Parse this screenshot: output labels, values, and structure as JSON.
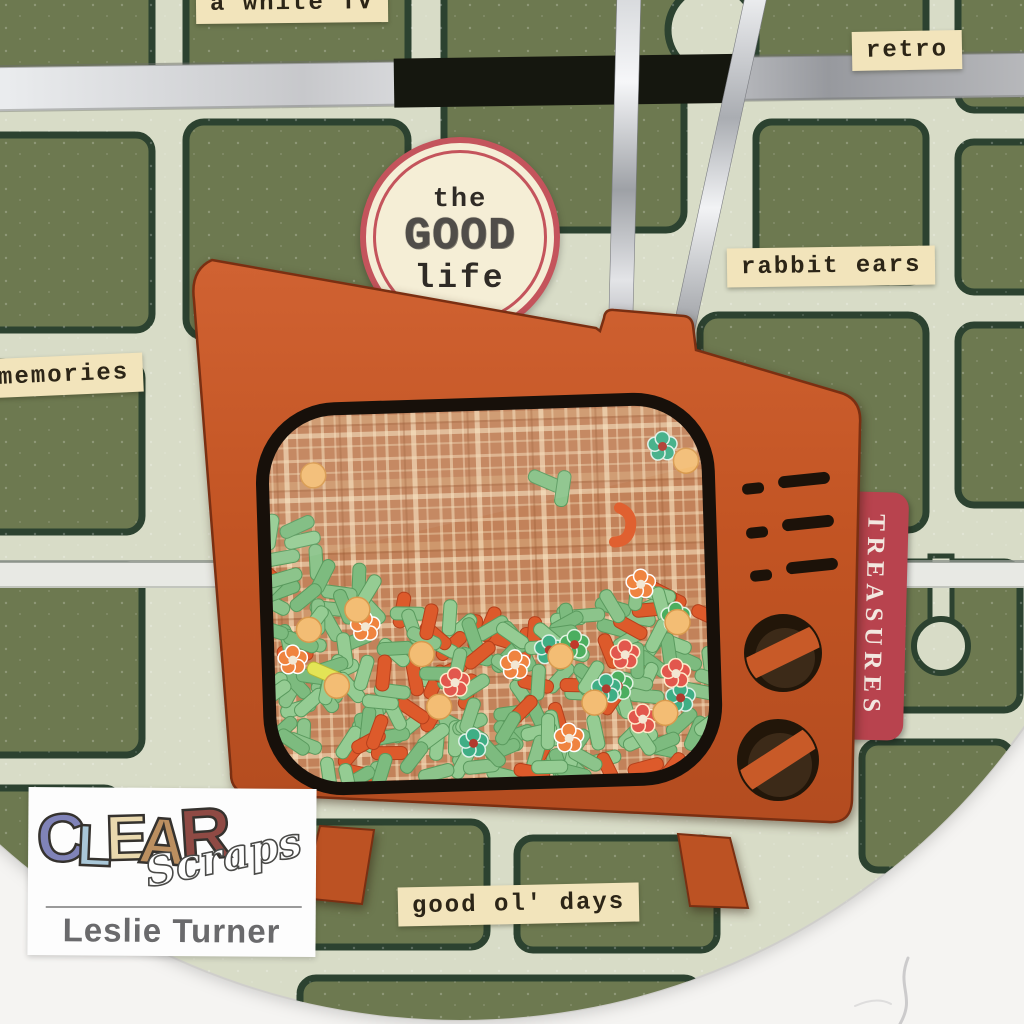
{
  "stickers": {
    "top_partial": "a white TV",
    "retro": "retro",
    "rabbit_ears": "rabbit ears",
    "memories": "memories",
    "good_ol_days": "good ol' days"
  },
  "badge": {
    "line1": "the",
    "line2": "GOOD",
    "line3": "life"
  },
  "tab": {
    "label": "TREASURES"
  },
  "logo": {
    "letters": [
      {
        "ch": "C",
        "color": "#8083b8",
        "rot": -5,
        "dy": 6,
        "size": 68
      },
      {
        "ch": "L",
        "color": "#a9c7d8",
        "rot": 2,
        "dy": 10,
        "size": 58
      },
      {
        "ch": "E",
        "color": "#ead9ae",
        "rot": -2,
        "dy": 4,
        "size": 64
      },
      {
        "ch": "A",
        "color": "#bb8f60",
        "rot": 4,
        "dy": 8,
        "size": 66
      },
      {
        "ch": "R",
        "color": "#8f4a44",
        "rot": -4,
        "dy": 2,
        "size": 72
      }
    ],
    "script": "Scraps",
    "byline": "Leslie Turner"
  },
  "colors": {
    "page": "#f5f4f2",
    "plaque_green": "#6d7950",
    "road": "#d8dcc7",
    "outline": "#2c4230",
    "tv": "#c85a28",
    "screen_base": "#c2825a",
    "tab": "#b8434e",
    "sticker_bg": "#f2e4bb",
    "sticker_text": "#2c2517",
    "badge_bg": "#f5eed6",
    "badge_ring": "#c4545c",
    "antenna": "#c9cbcf",
    "sprinkle_green": "#84c083",
    "sprinkle_orange": "#dd5a2b",
    "flower_teal": "#3fae85",
    "flower_orange": "#ef8440",
    "dot_peach": "#f3bd74"
  },
  "shaker": {
    "seed": 11,
    "rod_count": 215,
    "green_ratio": 0.78,
    "flower_count": 15,
    "dot_count": 9
  }
}
